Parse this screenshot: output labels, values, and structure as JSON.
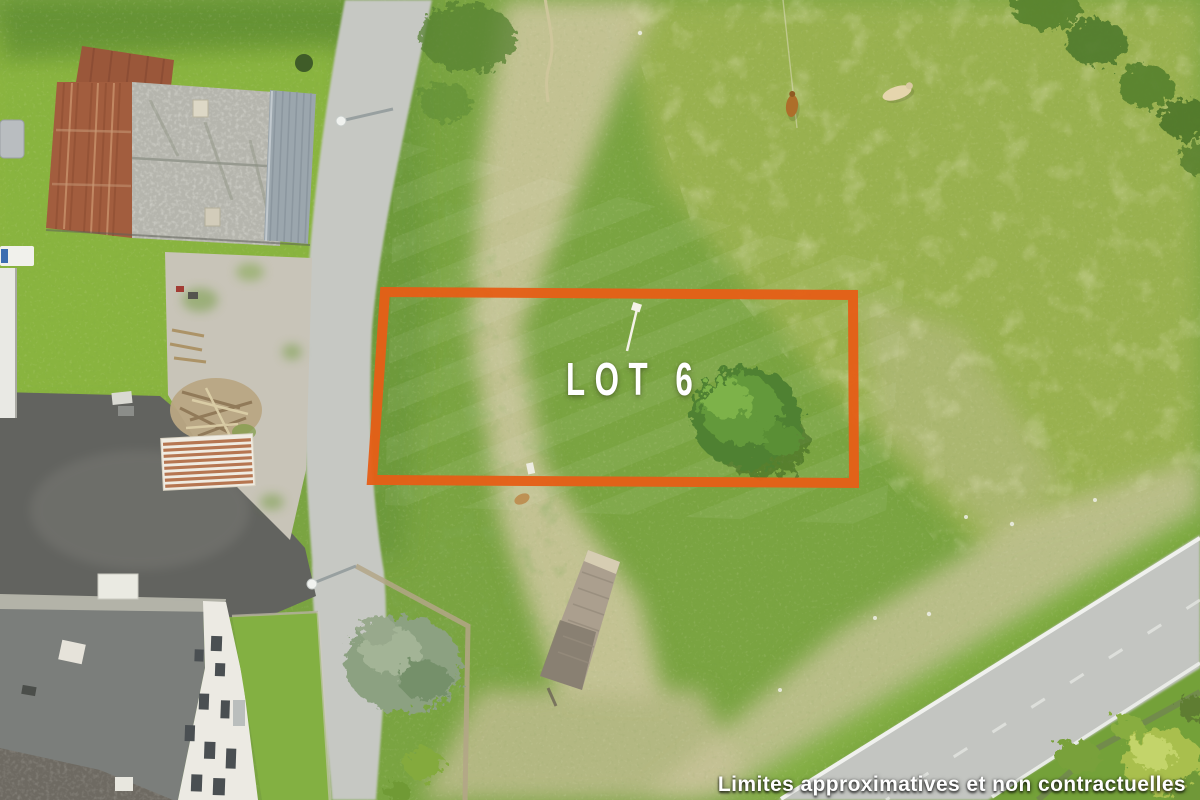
{
  "overlay": {
    "lot_label": "LOT 6",
    "disclaimer": "Limites approximatives et non contractuelles"
  },
  "colors": {
    "lot_outline": "#E55F17",
    "overlay_text": "#FFFFFF"
  },
  "scene": {
    "type": "aerial-drone-photo",
    "features": [
      "pasture",
      "village-road",
      "main-road",
      "barn-rust-roof",
      "barn-gray-roof",
      "farmhouse",
      "wood-pile",
      "striped-shed",
      "trailer-platform",
      "trees",
      "cows",
      "street-lamps",
      "survey-stake"
    ]
  }
}
